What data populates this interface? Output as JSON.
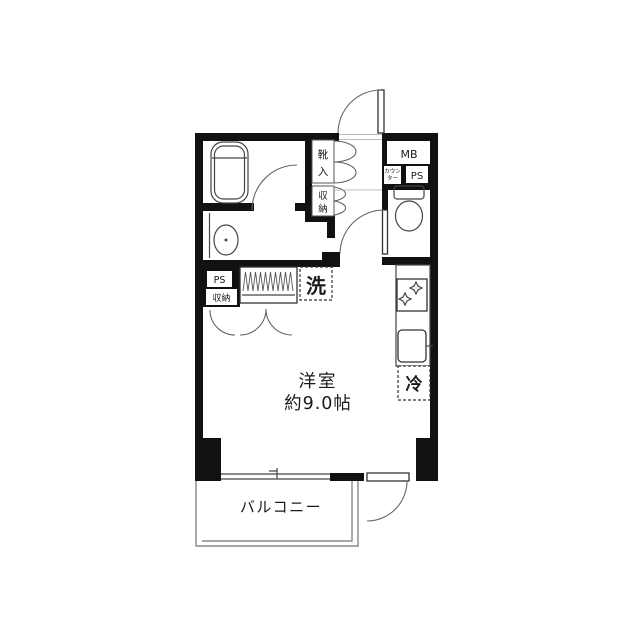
{
  "page": {
    "background": "#ffffff",
    "type": "apartment-floor-plan"
  },
  "colors": {
    "wall": "#111111",
    "line": "#444444",
    "balcony_line": "#888888",
    "text": "#1a1a1a",
    "counter_text": "#555555"
  },
  "plan": {
    "main_room": {
      "name": "洋室",
      "size": "約9.0帖"
    },
    "balcony": {
      "name": "バルコニー"
    },
    "labels": {
      "shoe_box": "靴入",
      "hall_storage": "収納",
      "meter_box": "MB",
      "counter": "カウンター",
      "counter_lines": [
        "カウン",
        "ター"
      ],
      "ps_right": "PS",
      "ps_left": "PS",
      "storage_left": "収納",
      "washing_machine": "洗",
      "refrigerator": "冷"
    }
  }
}
